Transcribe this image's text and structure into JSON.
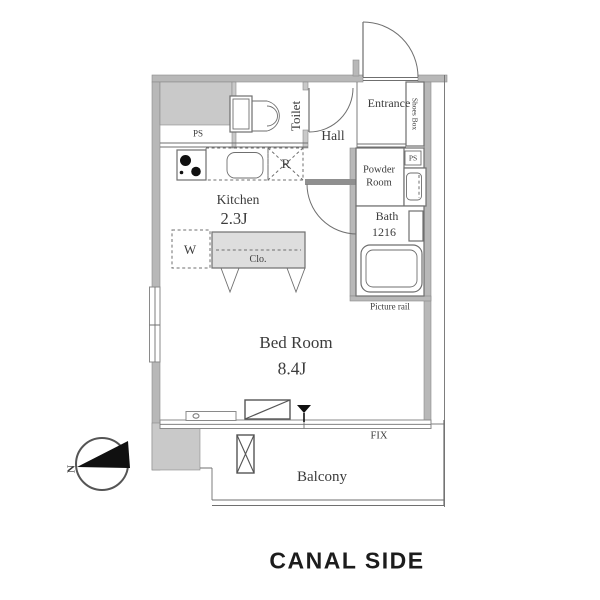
{
  "colors": {
    "wall_fill": "#b8b8b8",
    "wall_dark": "#8f8f8f",
    "wall_stroke": "#8a8a8a",
    "column_fill": "#c9c9c9",
    "closet_fill": "#dedede",
    "line": "#6f6f6f",
    "text": "#3c3c3c",
    "caption": "#1c1c1c",
    "needle": "#101010"
  },
  "labels": {
    "toilet": "Toilet",
    "hall": "Hall",
    "entrance": "Entrance",
    "shoes_box": "Shoes Box",
    "ps_left": "PS",
    "ps_right": "PS",
    "powder_room": "Powder\nRoom",
    "bath": "Bath",
    "bath_size": "1216",
    "picture_rail": "Picture rail",
    "kitchen": "Kitchen",
    "kitchen_size": "2.3J",
    "fridge": "R",
    "washer": "W",
    "closet": "Clo.",
    "bedroom": "Bed Room",
    "bedroom_size": "8.4J",
    "fix": "FIX",
    "balcony": "Balcony",
    "north": "N"
  },
  "caption": "CANAL SIDE"
}
